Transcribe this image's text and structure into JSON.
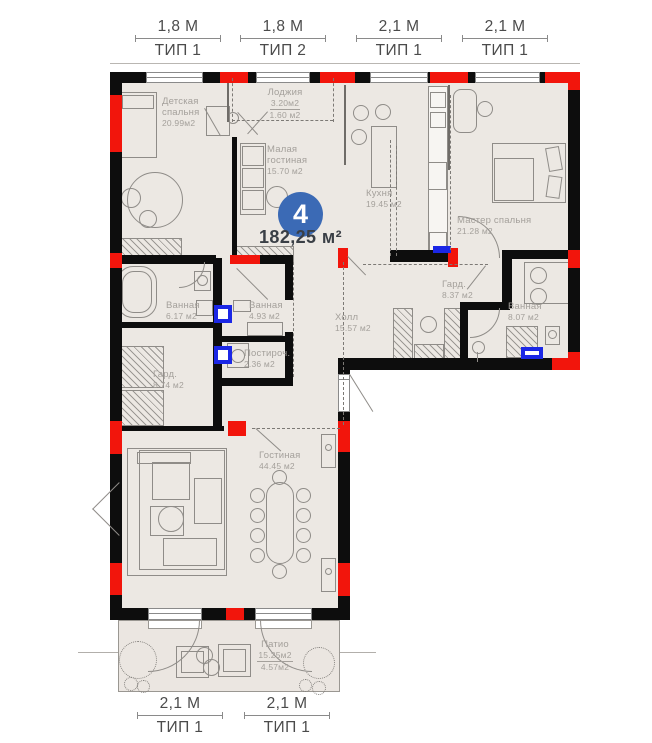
{
  "unit": {
    "number": "4",
    "total_area": "182,25 м²"
  },
  "dimensions": {
    "top": [
      {
        "value": "1,8 М",
        "type": "ТИП 1"
      },
      {
        "value": "1,8 М",
        "type": "ТИП 2"
      },
      {
        "value": "2,1 М",
        "type": "ТИП 1"
      },
      {
        "value": "2,1 М",
        "type": "ТИП 1"
      }
    ],
    "bottom": [
      {
        "value": "2,1 М",
        "type": "ТИП 1"
      },
      {
        "value": "2,1 М",
        "type": "ТИП 1"
      }
    ]
  },
  "rooms": {
    "child_bedroom": {
      "name": "Детская\nспальня",
      "area": "20.99м2"
    },
    "loggia": {
      "name": "Лоджия",
      "area_main": "3.20м2",
      "area_secondary": "1.60 м2"
    },
    "small_living": {
      "name": "Малая\nгостиная",
      "area": "15.70 м2"
    },
    "kitchen": {
      "name": "Кухня",
      "area": "19.45 м2"
    },
    "master_bedroom": {
      "name": "Мастер спальня",
      "area": "21.28 м2"
    },
    "bathroom_1": {
      "name": "Ванная",
      "area": "6.17 м2"
    },
    "bathroom_2": {
      "name": "Ванная",
      "area": "4.93 м2"
    },
    "laundry": {
      "name": "Постироч.",
      "area": "2.36 м2"
    },
    "hall": {
      "name": "Холл",
      "area": "15.57 м2"
    },
    "wardrobe_1": {
      "name": "Гард.",
      "area": "8.37 м2"
    },
    "bathroom_3": {
      "name": "Ванная",
      "area": "8.07 м2"
    },
    "wardrobe_2": {
      "name": "Гард.",
      "area": "8.74 м2"
    },
    "living_room": {
      "name": "Гостиная",
      "area": "44.45 м2"
    },
    "patio": {
      "name": "Патио",
      "area_main": "15.25м2",
      "area_secondary": "4.57м2"
    }
  },
  "colors": {
    "floor": "#ece8e3",
    "wall": "#0d0d0d",
    "red": "#f2150c",
    "blue": "#1b27e6",
    "label": "#a4a09b",
    "dark": "#3a3f46",
    "badge": "#3b6ab5"
  }
}
